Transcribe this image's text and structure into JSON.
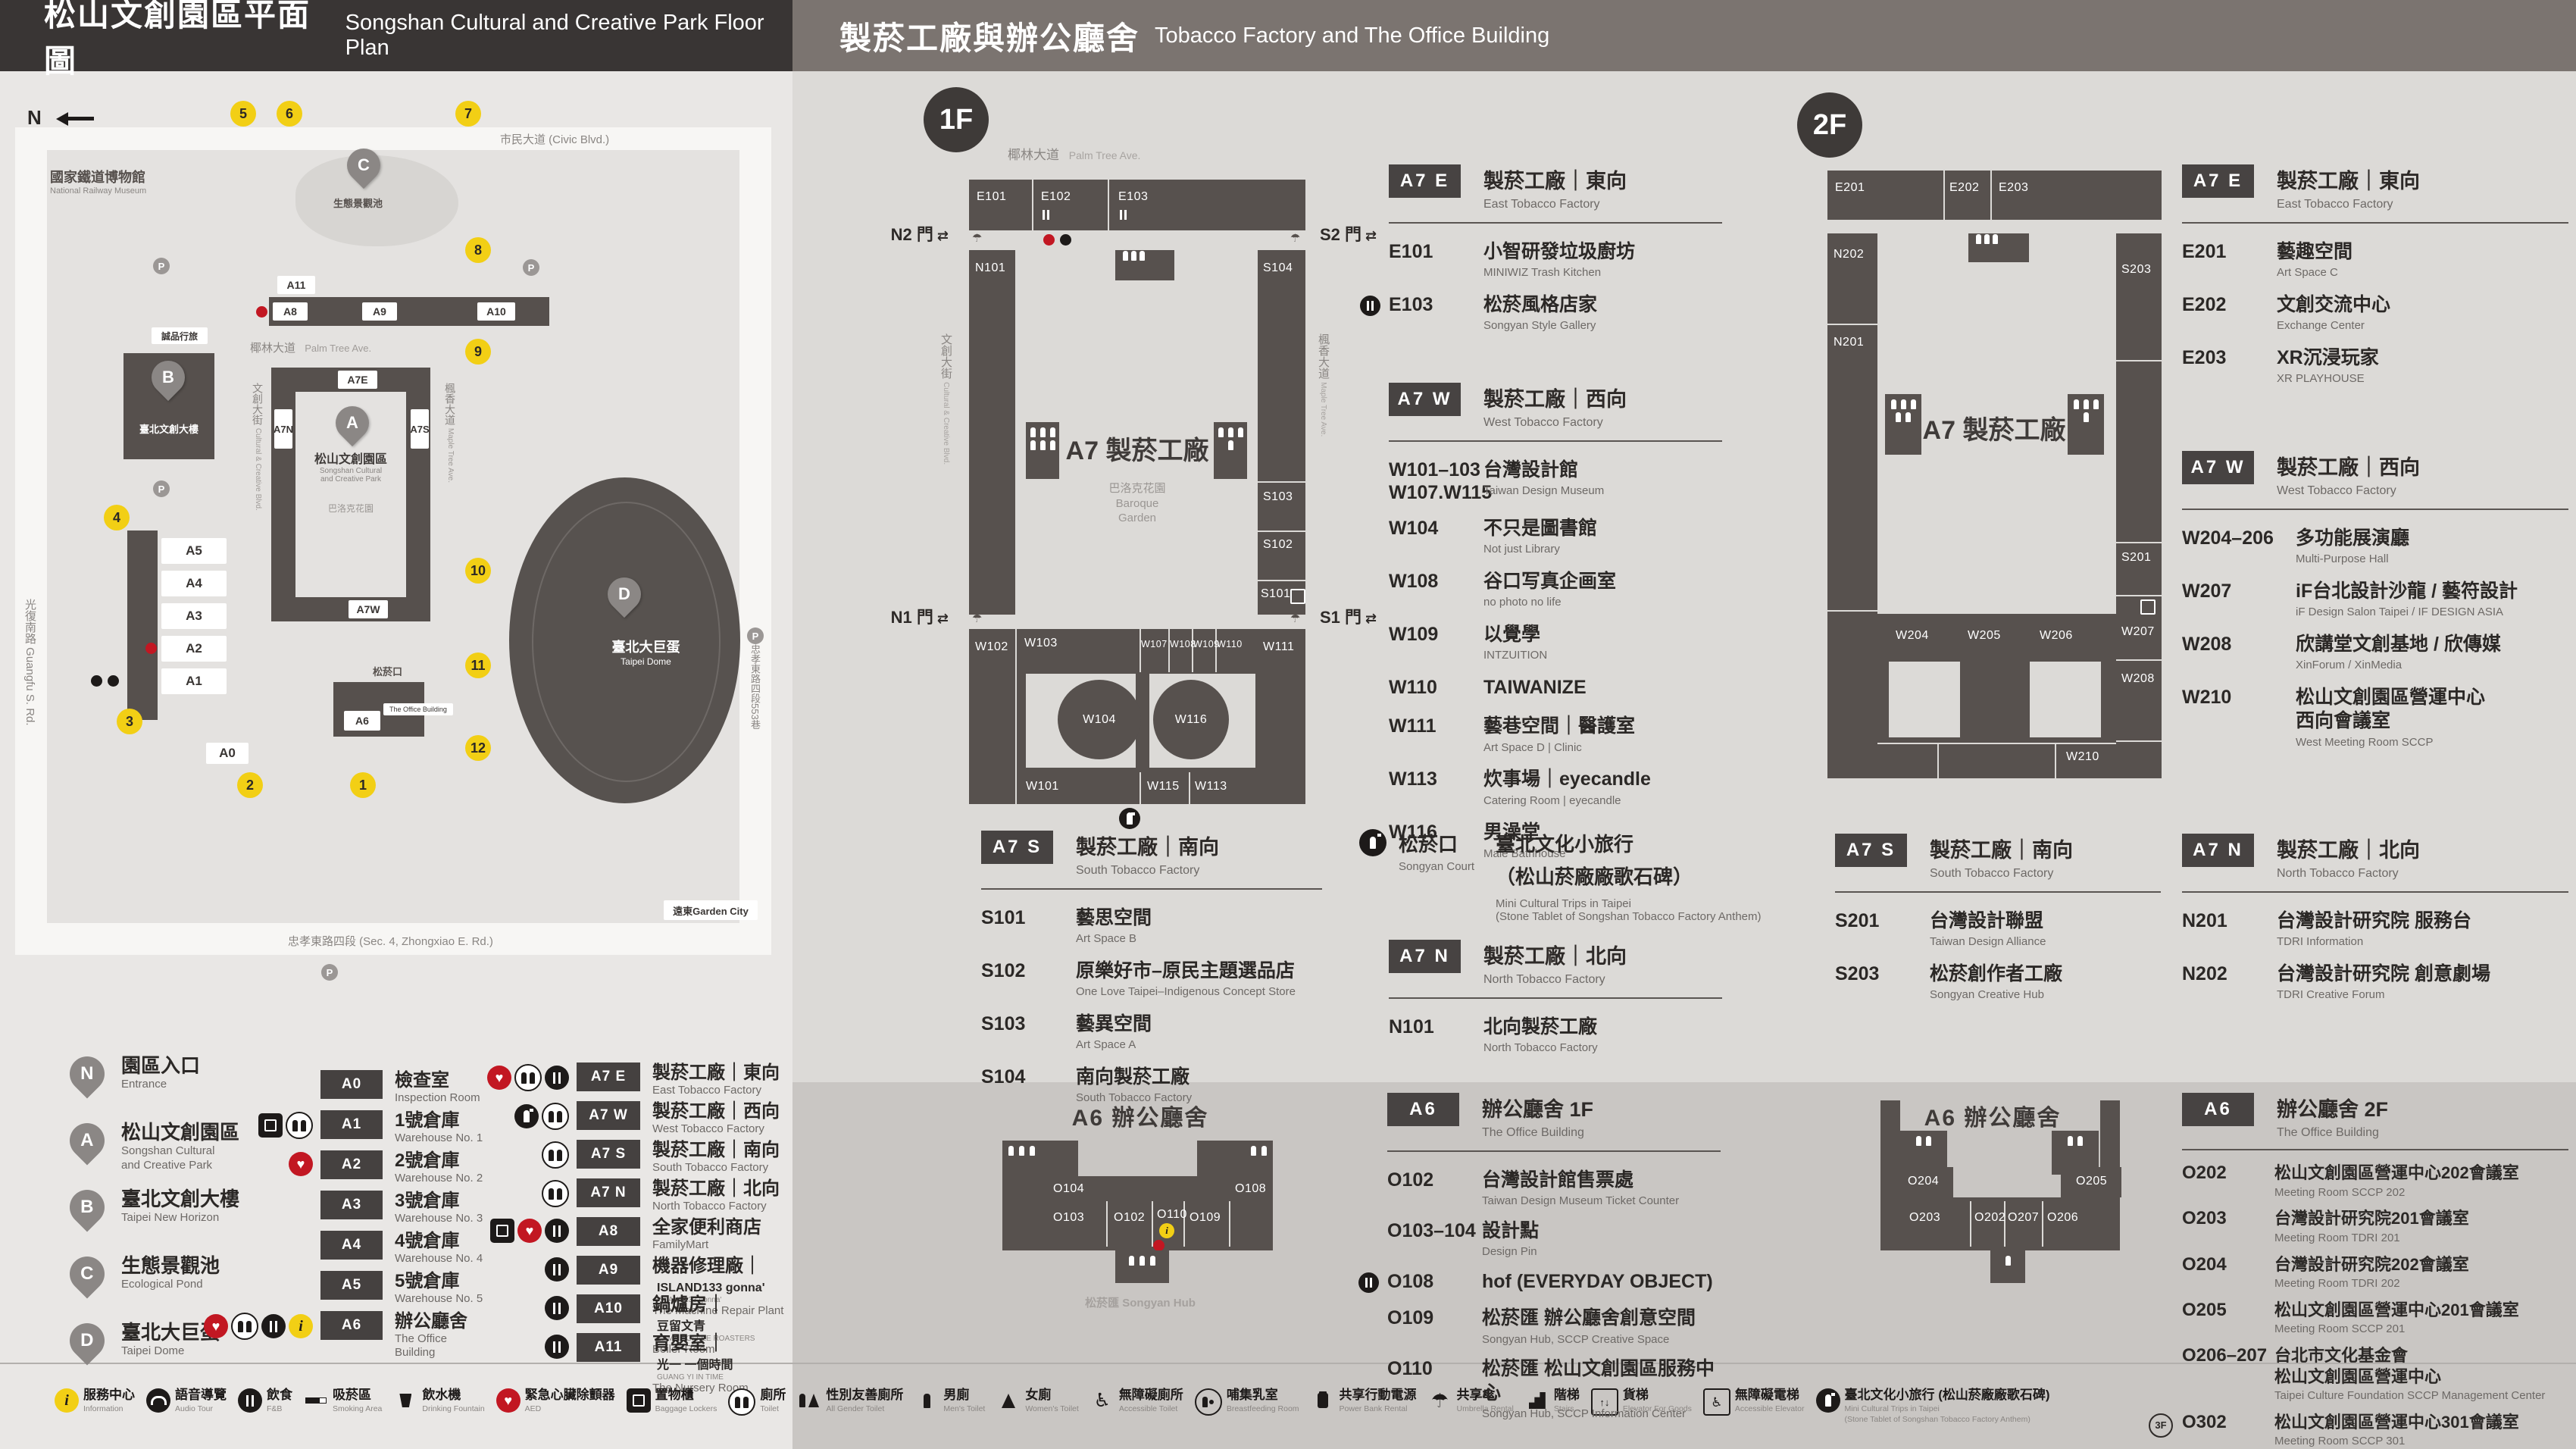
{
  "header": {
    "left_zh": "松山文創園區平面圖",
    "left_en": "Songshan Cultural and Creative Park Floor Plan",
    "right_zh": "製菸工廠與辦公廳舍",
    "right_en": "Tobacco Factory and The Office Building"
  },
  "map": {
    "compass": "N",
    "railway_zh": "國家鐵道博物館",
    "railway_en": "National Railway Museum",
    "streets": {
      "civic": "市民大道 (Civic Blvd.)",
      "guangfu": "光復南路 Guangfu S. Rd.",
      "zhongxiao": "忠孝東路四段 (Sec. 4, Zhongxiao E. Rd.)",
      "lane553": "忠孝東路四段553巷",
      "palm_zh": "椰林大道",
      "palm_en": "Palm Tree Ave.",
      "cultural_zh": "文創大街",
      "cultural_en": "Cultural & Creative Blvd.",
      "maple_zh": "楓香大道",
      "maple_en": "Maple Tree Ave."
    },
    "pond_label": "生態景觀池",
    "eslite": "誠品行旅",
    "new_horizon": "臺北文創大樓",
    "park_zh": "松山文創園區",
    "park_en1": "Songshan Cultural",
    "park_en2": "and Creative Park",
    "baroque": "巴洛克花園",
    "court": "松菸口",
    "office_chip": "The Office Building",
    "dome_zh": "臺北大巨蛋",
    "dome_en": "Taipei Dome",
    "garden_city": "遠東Garden City",
    "parking": "P",
    "chips": {
      "a0": "A0",
      "a1": "A1",
      "a2": "A2",
      "a3": "A3",
      "a4": "A4",
      "a5": "A5",
      "a6": "A6",
      "a7e": "A7E",
      "a7w": "A7W",
      "a7n": "A7N",
      "a7s": "A7S",
      "a8": "A8",
      "a9": "A9",
      "a10": "A10",
      "a11": "A11"
    },
    "pins": {
      "a": "A",
      "b": "B",
      "c": "C",
      "d": "D"
    },
    "numbers": [
      "1",
      "2",
      "3",
      "4",
      "5",
      "6",
      "7",
      "8",
      "9",
      "10",
      "11",
      "12"
    ]
  },
  "legend": {
    "places": [
      {
        "badge": "N",
        "zh": "園區入口",
        "en": "Entrance"
      },
      {
        "badge": "A",
        "zh": "松山文創園區",
        "en": "Songshan Cultural",
        "en2": "and Creative Park"
      },
      {
        "badge": "B",
        "zh": "臺北文創大樓",
        "en": "Taipei New Horizon"
      },
      {
        "badge": "C",
        "zh": "生態景觀池",
        "en": "Ecological Pond"
      },
      {
        "badge": "D",
        "zh": "臺北大巨蛋",
        "en": "Taipei Dome"
      }
    ],
    "col_a": [
      {
        "code": "A0",
        "zh": "檢查室",
        "en": "Inspection Room",
        "icons": []
      },
      {
        "code": "A1",
        "zh": "1號倉庫",
        "en": "Warehouse No. 1",
        "icons": [
          "locker",
          "toilet"
        ]
      },
      {
        "code": "A2",
        "zh": "2號倉庫",
        "en": "Warehouse No. 2",
        "icons": [
          "aed"
        ]
      },
      {
        "code": "A3",
        "zh": "3號倉庫",
        "en": "Warehouse No. 3",
        "icons": []
      },
      {
        "code": "A4",
        "zh": "4號倉庫",
        "en": "Warehouse No. 4",
        "icons": []
      },
      {
        "code": "A5",
        "zh": "5號倉庫",
        "en": "Warehouse No. 5",
        "icons": []
      },
      {
        "code": "A6",
        "zh": "辦公廳舍",
        "en": "The Office Building",
        "icons": [
          "aed",
          "toilet",
          "fnb",
          "info"
        ]
      }
    ],
    "col_b": [
      {
        "code": "A7 E",
        "zh": "製菸工廠｜東向",
        "en": "East Tobacco Factory",
        "icons": [
          "aed",
          "toilet",
          "fnb"
        ]
      },
      {
        "code": "A7 W",
        "zh": "製菸工廠｜西向",
        "en": "West Tobacco Factory",
        "icons": [
          "mini",
          "toilet"
        ]
      },
      {
        "code": "A7 S",
        "zh": "製菸工廠｜南向",
        "en": "South Tobacco Factory",
        "icons": [
          "toilet"
        ]
      },
      {
        "code": "A7 N",
        "zh": "製菸工廠｜北向",
        "en": "North Tobacco Factory",
        "icons": [
          "toilet"
        ]
      },
      {
        "code": "A8",
        "zh": "全家便利商店",
        "en": "FamilyMart",
        "icons": [
          "locker",
          "aed",
          "fnb"
        ]
      },
      {
        "code": "A9",
        "zh": "機器修理廠",
        "sep": "｜",
        "brand": "ISLAND133 gonna'",
        "brand_sub": "ISLAND133 gonna'",
        "en": "The Machine Repair Plant",
        "icons": [
          "fnb"
        ]
      },
      {
        "code": "A10",
        "zh": "鍋爐房",
        "sep": "｜",
        "brand": "豆留文青",
        "brand_sub": "CAMA COFFEE ROASTERS",
        "en": "Boiler Room",
        "icons": [
          "fnb"
        ]
      },
      {
        "code": "A11",
        "zh": "育嬰室",
        "sep": "｜",
        "brand": "光一 一個時間",
        "brand_sub": "GUANG YI IN TIME",
        "en": "The Nursery Room",
        "icons": [
          "fnb"
        ]
      }
    ]
  },
  "strip": {
    "items": [
      {
        "icons": [
          "info"
        ],
        "zh": "服務中心",
        "en": "Information"
      },
      {
        "icons": [
          "audio"
        ],
        "zh": "語音導覽",
        "en": "Audio Tour"
      },
      {
        "icons": [
          "fnb"
        ],
        "zh": "飲食",
        "en": "F&B"
      },
      {
        "icons": [
          "smoking"
        ],
        "zh": "吸菸區",
        "en": "Smoking Area"
      },
      {
        "icons": [
          "fountain"
        ],
        "zh": "飲水機",
        "en": "Drinking Fountain"
      },
      {
        "icons": [
          "aed"
        ],
        "zh": "緊急心臟除顫器",
        "en": "AED"
      },
      {
        "icons": [
          "locker"
        ],
        "zh": "置物櫃",
        "en": "Baggage Lockers"
      },
      {
        "icons": [
          "toilet"
        ],
        "zh": "廁所",
        "en": "Toilet"
      },
      {
        "icons": [
          "allgender"
        ],
        "zh": "性別友善廁所",
        "en": "All Gender Toilet"
      },
      {
        "icons": [
          "men"
        ],
        "zh": "男廁",
        "en": "Men's Toilet"
      },
      {
        "icons": [
          "women"
        ],
        "zh": "女廁",
        "en": "Women's Toilet"
      },
      {
        "icons": [
          "accessible"
        ],
        "zh": "無障礙廁所",
        "en": "Accessible Toilet"
      },
      {
        "icons": [
          "breastfeeding"
        ],
        "zh": "哺集乳室",
        "en": "Breastfeeding Room"
      },
      {
        "icons": [
          "powerbank"
        ],
        "zh": "共享行動電源",
        "en": "Power Bank Rental"
      },
      {
        "icons": [
          "umbrella"
        ],
        "zh": "共享傘",
        "en": "Umbrella Rental"
      },
      {
        "icons": [
          "stairs"
        ],
        "zh": "階梯",
        "en": "Stairs"
      },
      {
        "icons": [
          "goodslift"
        ],
        "zh": "貨梯",
        "en": "Elevator For Goods"
      },
      {
        "icons": [
          "acclift"
        ],
        "zh": "無障礙電梯",
        "en": "Accessible Elevator"
      },
      {
        "icons": [
          "mini"
        ],
        "zh": "臺北文化小旅行 (松山菸廠廠歌石碑)",
        "en": "Mini Cultural Trips in Taipei",
        "en2": "(Stone Tablet of Songshan Tobacco Factory Anthem)"
      }
    ]
  },
  "f1": {
    "badge": "1F",
    "plan": {
      "street_palm_zh": "椰林大道",
      "street_palm_en": "Palm Tree Ave.",
      "street_cultural_zh": "文創大街",
      "street_cultural_en": "Cultural & Creative Blvd.",
      "street_maple_zh": "楓香大道",
      "street_maple_en": "Maple Tree Ave.",
      "gate_n2": "N2 門",
      "gate_s2": "S2 門",
      "gate_n1": "N1 門",
      "gate_s1": "S1 門",
      "center_zh": "A7 製菸工廠",
      "baroque_zh": "巴洛克花園",
      "baroque_en1": "Baroque",
      "baroque_en2": "Garden",
      "rooms": {
        "e101": "E101",
        "e102": "E102",
        "e103": "E103",
        "n101": "N101",
        "s104": "S104",
        "s103": "S103",
        "s102": "S102",
        "s101": "S101",
        "w101": "W101",
        "w102": "W102",
        "w103": "W103",
        "w104": "W104",
        "w107": "W107",
        "w108": "W108",
        "w109": "W109",
        "w110": "W110",
        "w111": "W111",
        "w113": "W113",
        "w115": "W115",
        "w116": "W116"
      }
    },
    "a7e": {
      "code": "A7 E",
      "zh": "製菸工廠｜東向",
      "en": "East Tobacco Factory",
      "rows": [
        {
          "code": "E101",
          "zh": "小智研發垃圾廚坊",
          "en": "MINIWIZ Trash Kitchen"
        },
        {
          "code": "E103",
          "zh": "松菸風格店家",
          "en": "Songyan Style Gallery",
          "fnb": true
        }
      ]
    },
    "a7w": {
      "code": "A7 W",
      "zh": "製菸工廠｜西向",
      "en": "West Tobacco Factory",
      "rows": [
        {
          "code": "W101–103",
          "code2": "W107.W115",
          "zh": "台灣設計館",
          "en": "Taiwan Design Museum"
        },
        {
          "code": "W104",
          "zh": "不只是圖書館",
          "en": "Not just Library"
        },
        {
          "code": "W108",
          "zh": "谷口写真企画室",
          "en": "no photo no life"
        },
        {
          "code": "W109",
          "zh": "以覺學",
          "en": "INTZUITION"
        },
        {
          "code": "W110",
          "zh": "TAIWANIZE"
        },
        {
          "code": "W111",
          "zh": "藝巷空間｜醫護室",
          "en": "Art Space D | Clinic"
        },
        {
          "code": "W113",
          "zh": "炊事場｜eyecandle",
          "en": "Catering Room | eyecandle"
        },
        {
          "code": "W116",
          "zh": "男澡堂",
          "en": "Male Bathhouse"
        }
      ]
    },
    "a7s": {
      "code": "A7 S",
      "zh": "製菸工廠｜南向",
      "en": "South Tobacco Factory",
      "rows": [
        {
          "code": "S101",
          "zh": "藝思空間",
          "en": "Art Space B"
        },
        {
          "code": "S102",
          "zh": "原樂好市–原民主題選品店",
          "en": "One Love Taipei–Indigenous Concept Store"
        },
        {
          "code": "S103",
          "zh": "藝異空間",
          "en": "Art Space A"
        },
        {
          "code": "S104",
          "zh": "南向製菸工廠",
          "en": "South Tobacco Factory"
        }
      ]
    },
    "court": {
      "zh": "松菸口",
      "en": "Songyan Court",
      "title_zh": "臺北文化小旅行",
      "title_zh2": "（松山菸廠廠歌石碑）",
      "title_en1": "Mini Cultural Trips in Taipei",
      "title_en2": "(Stone Tablet of Songshan Tobacco Factory Anthem)"
    },
    "a7n": {
      "code": "A7 N",
      "zh": "製菸工廠｜北向",
      "en": "North Tobacco Factory",
      "rows": [
        {
          "code": "N101",
          "zh": "北向製菸工廠",
          "en": "North Tobacco Factory"
        }
      ]
    },
    "a6": {
      "code": "A6",
      "zh": "辦公廳舍 1F",
      "en": "The Office Building",
      "plan_title": "A6 辦公廳舍",
      "court_label": "松菸口 Songyan Court",
      "hub_label": "松菸匯 Songyan Hub",
      "rooms": {
        "o102": "O102",
        "o103": "O103",
        "o104": "O104",
        "o108": "O108",
        "o109": "O109",
        "o110": "O110"
      },
      "rows": [
        {
          "code": "O102",
          "zh": "台灣設計館售票處",
          "en": "Taiwan Design Museum Ticket Counter"
        },
        {
          "code": "O103–104",
          "zh": "設計點",
          "en": "Design Pin"
        },
        {
          "code": "O108",
          "zh": "hof (EVERYDAY OBJECT)",
          "fnb": true
        },
        {
          "code": "O109",
          "zh": "松菸匯 辦公廳舍創意空間",
          "en": "Songyan Hub, SCCP Creative Space"
        },
        {
          "code": "O110",
          "zh": "松菸匯 松山文創園區服務中心",
          "en": "Songyan Hub, SCCP Information Center"
        }
      ]
    }
  },
  "f2": {
    "badge": "2F",
    "plan": {
      "center_zh": "A7 製菸工廠",
      "rooms": {
        "e201": "E201",
        "e202": "E202",
        "e203": "E203",
        "n201": "N201",
        "n202": "N202",
        "s201": "S201",
        "s203": "S203",
        "w204": "W204",
        "w205": "W205",
        "w206": "W206",
        "w207": "W207",
        "w208": "W208",
        "w210": "W210"
      }
    },
    "a7e": {
      "code": "A7 E",
      "zh": "製菸工廠｜東向",
      "en": "East Tobacco Factory",
      "rows": [
        {
          "code": "E201",
          "zh": "藝趣空間",
          "en": "Art Space C"
        },
        {
          "code": "E202",
          "zh": "文創交流中心",
          "en": "Exchange Center"
        },
        {
          "code": "E203",
          "zh": "XR沉浸玩家",
          "en": "XR PLAYHOUSE"
        }
      ]
    },
    "a7w": {
      "code": "A7 W",
      "zh": "製菸工廠｜西向",
      "en": "West Tobacco Factory",
      "rows": [
        {
          "code": "W204–206",
          "zh": "多功能展演廳",
          "en": "Multi-Purpose Hall"
        },
        {
          "code": "W207",
          "zh": "iF台北設計沙龍 / 藝符設計",
          "en": "iF Design Salon Taipei / IF DESIGN ASIA"
        },
        {
          "code": "W208",
          "zh": "欣講堂文創基地 / 欣傳媒",
          "en": "XinForum / XinMedia"
        },
        {
          "code": "W210",
          "zh": "松山文創園區營運中心",
          "zh2": "西向會議室",
          "en": "West Meeting Room SCCP"
        }
      ]
    },
    "a7s": {
      "code": "A7 S",
      "zh": "製菸工廠｜南向",
      "en": "South Tobacco Factory",
      "rows": [
        {
          "code": "S201",
          "zh": "台灣設計聯盟",
          "en": "Taiwan Design Alliance"
        },
        {
          "code": "S203",
          "zh": "松菸創作者工廠",
          "en": "Songyan Creative Hub"
        }
      ]
    },
    "a7n": {
      "code": "A7 N",
      "zh": "製菸工廠｜北向",
      "en": "North Tobacco Factory",
      "rows": [
        {
          "code": "N201",
          "zh": "台灣設計研究院 服務台",
          "en": "TDRI Information"
        },
        {
          "code": "N202",
          "zh": "台灣設計研究院 創意劇場",
          "en": "TDRI Creative Forum"
        }
      ]
    },
    "a6": {
      "code": "A6",
      "zh": "辦公廳舍 2F",
      "en": "The Office Building",
      "plan_title": "A6 辦公廳舍",
      "rooms": {
        "o202": "O202",
        "o203": "O203",
        "o204": "O204",
        "o205": "O205",
        "o206": "O206",
        "o207": "O207"
      },
      "rows": [
        {
          "code": "O202",
          "zh": "松山文創園區營運中心202會議室",
          "en": "Meeting Room SCCP 202"
        },
        {
          "code": "O203",
          "zh": "台灣設計研究院201會議室",
          "en": "Meeting Room TDRI 201"
        },
        {
          "code": "O204",
          "zh": "台灣設計研究院202會議室",
          "en": "Meeting Room TDRI 202"
        },
        {
          "code": "O205",
          "zh": "松山文創園區營運中心201會議室",
          "en": "Meeting Room SCCP 201"
        },
        {
          "code": "O206–207",
          "zh": "台北市文化基金會",
          "zh2": "松山文創園區營運中心",
          "en": "Taipei Culture Foundation SCCP Management Center"
        },
        {
          "code": "O302",
          "floor_badge": "3F",
          "zh": "松山文創園區營運中心301會議室",
          "en": "Meeting Room SCCP 301"
        }
      ]
    }
  }
}
